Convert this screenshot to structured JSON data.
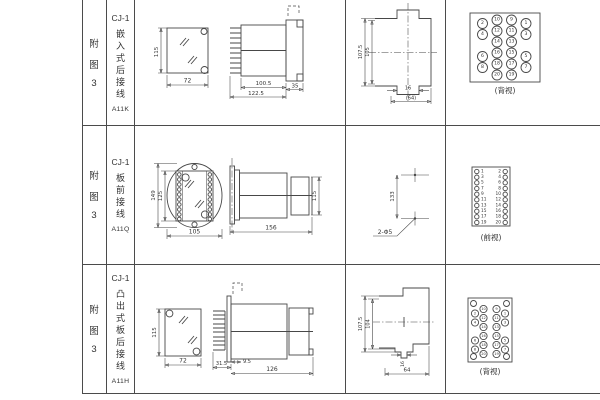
{
  "colors": {
    "line": "#474747",
    "grid": "#4b4b4b",
    "text": "#333333",
    "bg": "#ffffff"
  },
  "rows": [
    {
      "fig": [
        "附",
        "图",
        "3"
      ],
      "model": "CJ-1",
      "type_chars": [
        "嵌",
        "入",
        "式",
        "后",
        "接",
        "线"
      ],
      "code": "A11K",
      "dims": {
        "front_h": "115",
        "front_w": "72",
        "side_a": "100.5",
        "side_b": "122.5",
        "side_c": "35",
        "cut_a": "107.5",
        "cut_b": "105",
        "cut_c": "16",
        "cut_d": "(64)"
      },
      "view_label": "(背视)",
      "term": {
        "ol": [
          "2",
          "4",
          "6",
          "8"
        ],
        "ml": [
          "10",
          "12",
          "14",
          "16",
          "18",
          "20"
        ],
        "mr": [
          "9",
          "11",
          "13",
          "15",
          "17",
          "19"
        ],
        "or": [
          "1",
          "3",
          "5",
          "7"
        ]
      }
    },
    {
      "fig": [
        "附",
        "图",
        "3"
      ],
      "model": "CJ-1",
      "type_chars": [
        "板",
        "前",
        "接",
        "线"
      ],
      "code": "A11Q",
      "dims": {
        "front_h": "149",
        "front_i": "125",
        "front_w": "105",
        "side_len": "156",
        "side_h": "115",
        "drill_v": "133",
        "drill_label": "2-Φ5"
      },
      "view_label": "(前视)",
      "term": {
        "left": [
          "1",
          "3",
          "5",
          "7",
          "9",
          "11",
          "13",
          "15",
          "17",
          "19"
        ],
        "right": [
          "2",
          "4",
          "6",
          "8",
          "10",
          "12",
          "14",
          "16",
          "18",
          "20"
        ]
      }
    },
    {
      "fig": [
        "附",
        "图",
        "3"
      ],
      "model": "CJ-1",
      "type_chars": [
        "凸",
        "出",
        "式",
        "板",
        "后",
        "接",
        "线"
      ],
      "code": "A11H",
      "dims": {
        "front_h": "115",
        "front_w": "72",
        "side_a": "31.5",
        "side_b": "9.5",
        "side_c": "126",
        "cut_a": "107.5",
        "cut_b": "104",
        "cut_c": "16",
        "cut_d": "64"
      },
      "view_label": "(背视)",
      "term": {
        "ol": [
          "2",
          "4",
          "6",
          "8"
        ],
        "ml": [
          "10",
          "12",
          "14",
          "16",
          "18",
          "20"
        ],
        "mr": [
          "9",
          "11",
          "13",
          "15",
          "17",
          "19"
        ],
        "or": [
          "1",
          "3",
          "5",
          "7"
        ]
      }
    }
  ]
}
